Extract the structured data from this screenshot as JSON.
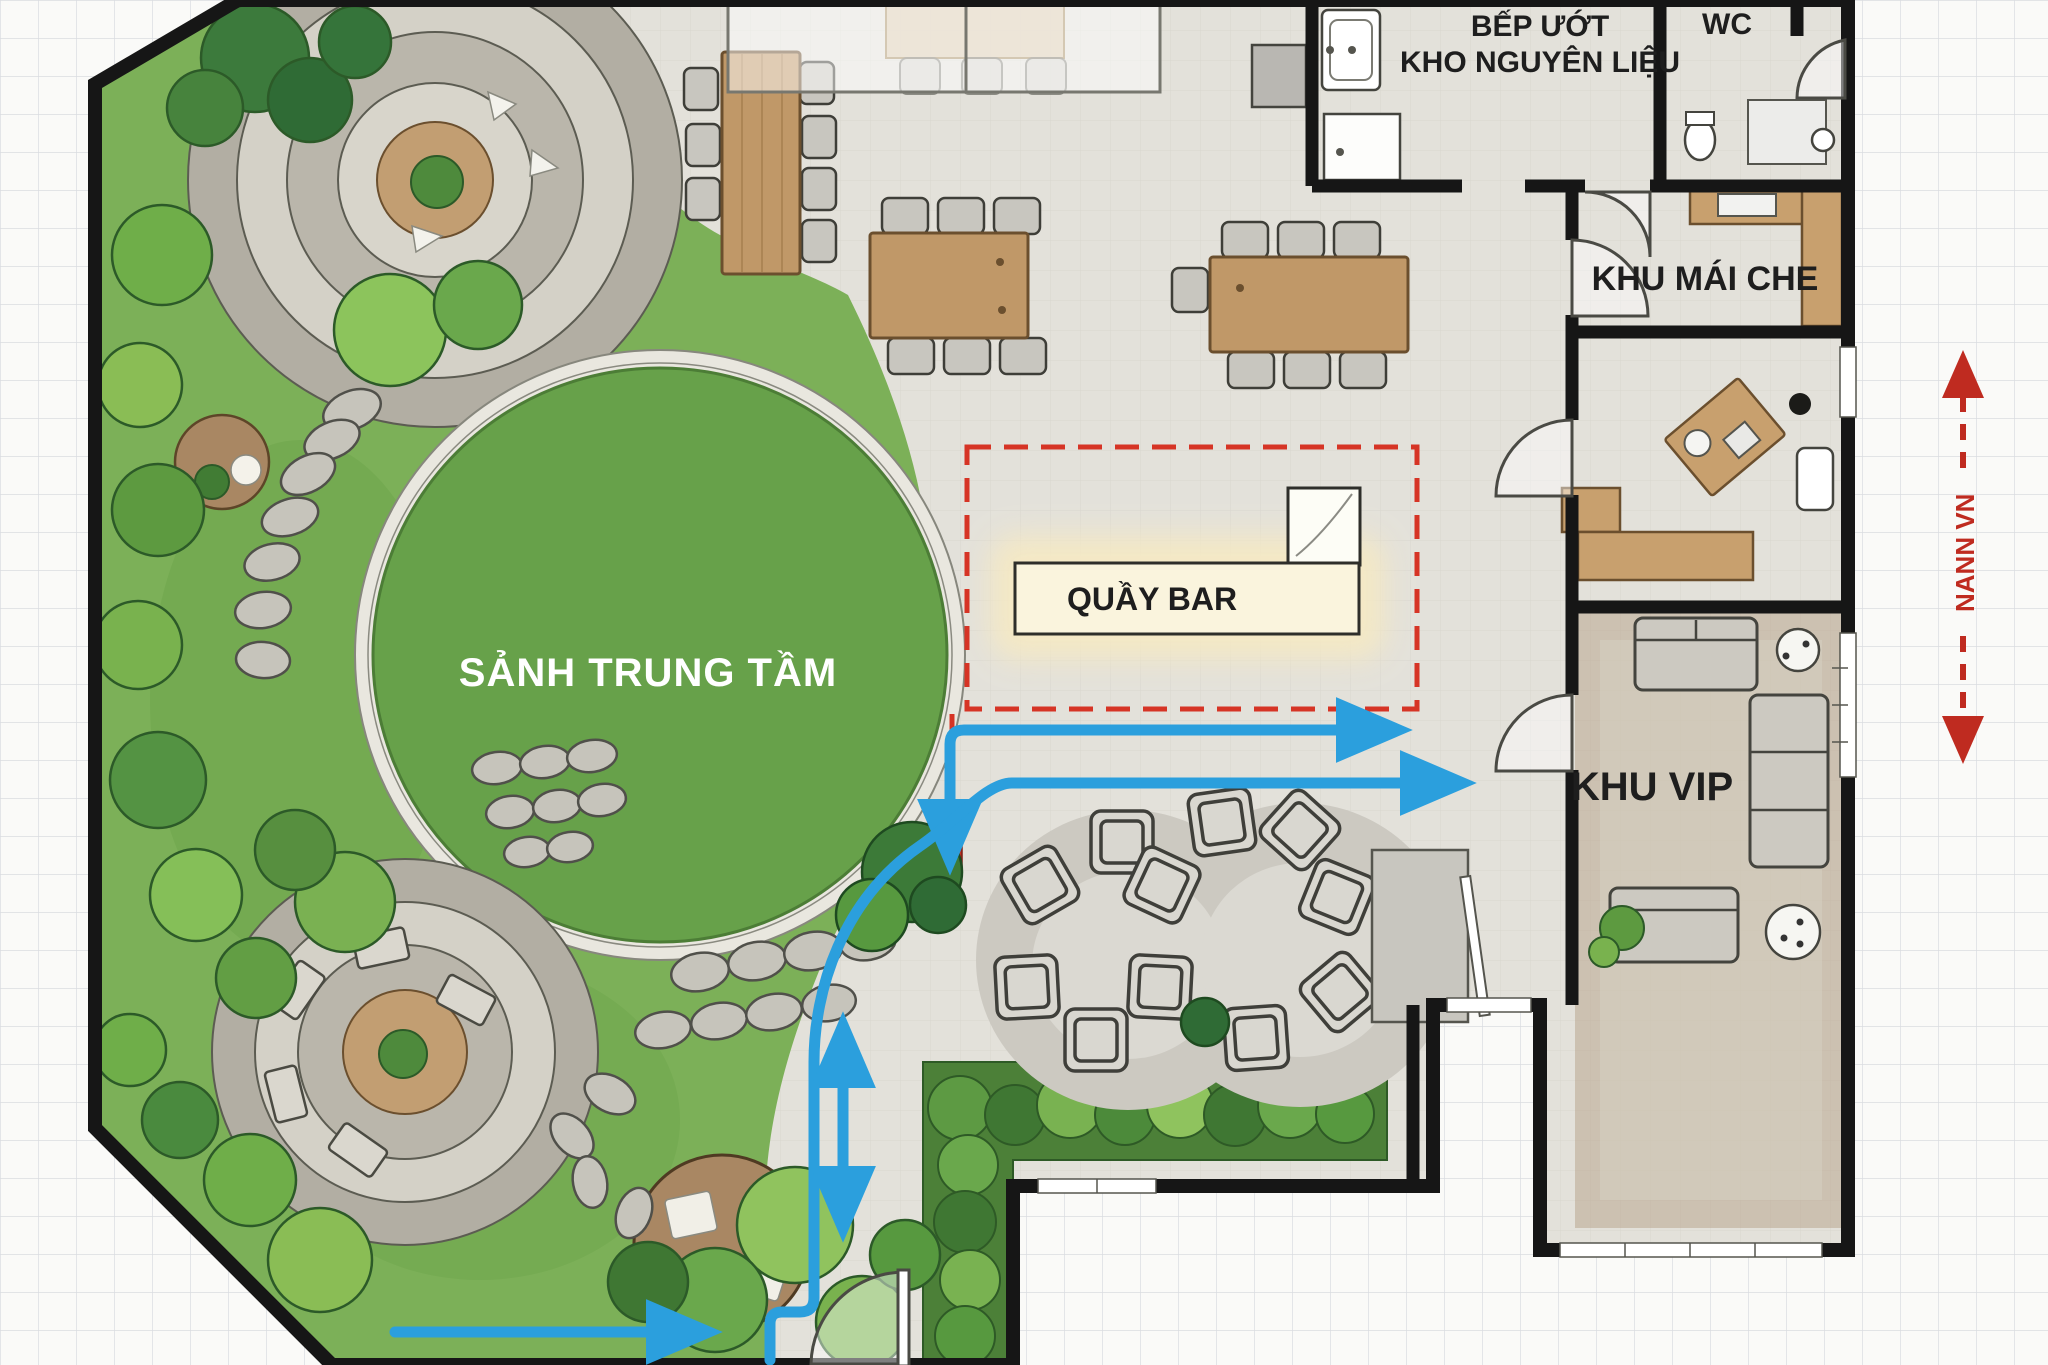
{
  "plan": {
    "labels": {
      "central_hall": "SẢNH TRUNG TẦM",
      "bar": "QUẦY BAR",
      "wet_kitchen_line1": "BẾP ƯỚT",
      "wet_kitchen_line2": "KHO NGUYÊN LIỆU",
      "wc": "WC",
      "covered_area": "KHU MÁI CHE",
      "vip_area": "KHU VIP",
      "side_note": "NANN VN"
    },
    "colors": {
      "flow_arrow_blue": "#2b9fdd",
      "highlight_red": "#d63425",
      "measure_red": "#bf2b20",
      "lawn_green": "#67a14a",
      "garden_green": "#7cb058",
      "floor_gray": "#e3e1da",
      "wall_black": "#161616",
      "wood": "#c09868",
      "bar_cream": "#faf4dd"
    }
  }
}
